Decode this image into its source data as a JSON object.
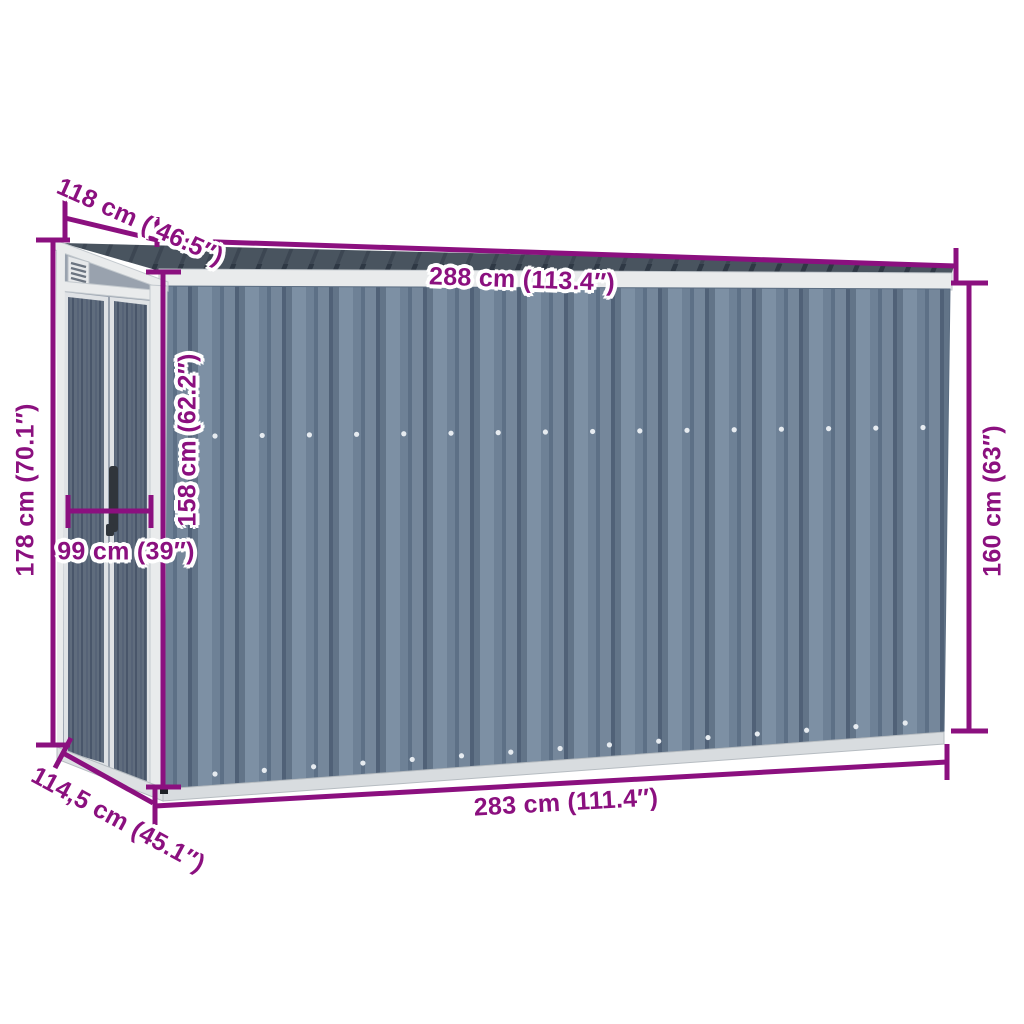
{
  "page": {
    "type": "product-dimension-diagram",
    "subject": "wall-mounted grey steel garden shed with sliding doors",
    "background": "#ffffff"
  },
  "accent": {
    "dimension_color": "#8B107F",
    "halo_color": "#ffffff"
  },
  "palette": {
    "roof": "#49545f",
    "roof_rib": "#303a46",
    "trim_white": "#e9ebec",
    "side_face": "#99a2ae",
    "wall_base": "#6e8196",
    "wall_groove": "#506177",
    "wall_light": "#7d90a4",
    "door_panel": "#5f6c7d",
    "door_rib": "#49566a",
    "base_rail": "#dde0e3",
    "handle": "#30353b"
  },
  "dimensions": {
    "roof_depth": {
      "label": "118 cm ( 46.5″)",
      "cm": 118,
      "inches": 46.5
    },
    "roof_width": {
      "label": "288 cm (113.4″)",
      "cm": 288,
      "inches": 113.4
    },
    "back_height": {
      "label": "178 cm (70.1″)",
      "cm": 178,
      "inches": 70.1
    },
    "front_wall_height": {
      "label": "158 cm (62.2″)",
      "cm": 158,
      "inches": 62.2
    },
    "door_width": {
      "label": "99 cm (39″)",
      "cm": 99,
      "inches": 39
    },
    "right_wall_height": {
      "label": "160 cm (63″)",
      "cm": 160,
      "inches": 63
    },
    "base_width": {
      "label": "283 cm (111.4″)",
      "cm": 283,
      "inches": 111.4
    },
    "base_depth": {
      "label": "114,5 cm (45.1″)",
      "cm": 114.5,
      "inches": 45.1
    }
  }
}
